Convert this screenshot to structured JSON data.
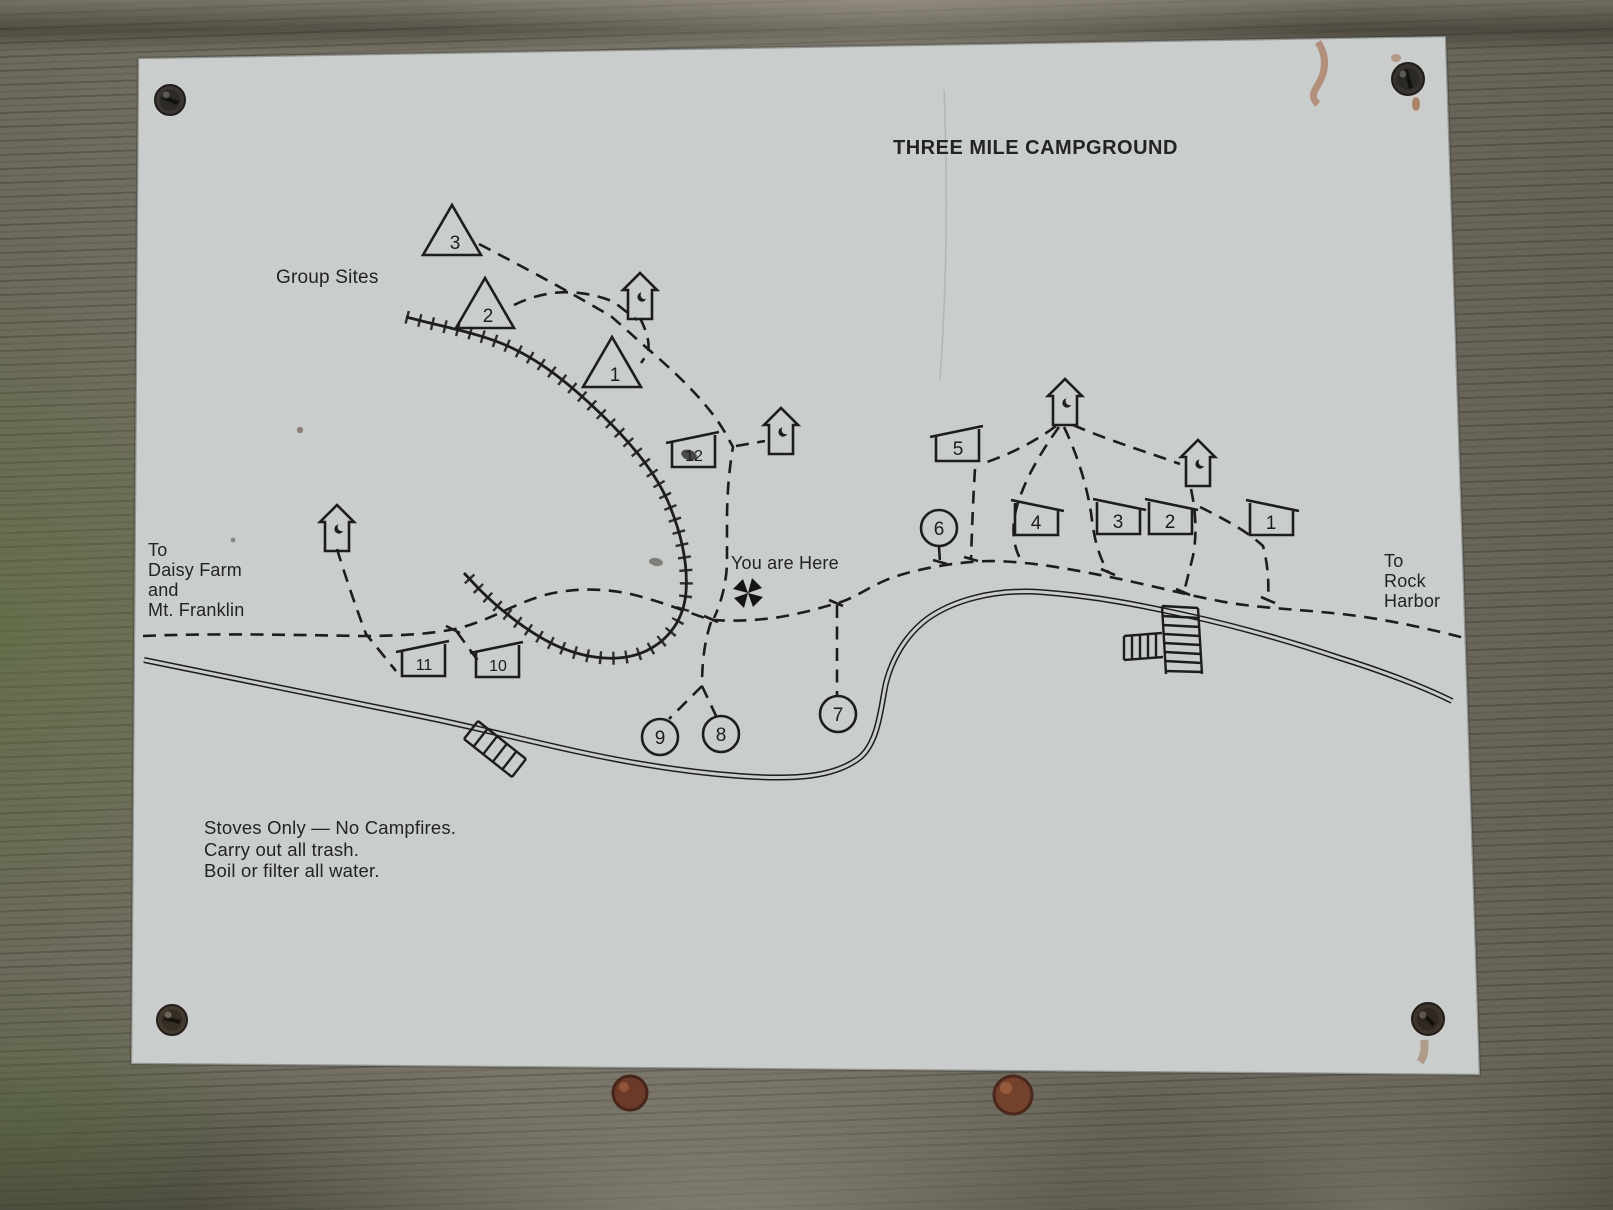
{
  "photo": {
    "sign_title": "THREE MILE CAMPGROUND",
    "labels": {
      "group_sites": "Group Sites",
      "you_are_here": "You are Here",
      "dest_left_lines": [
        "To",
        "Daisy Farm",
        "and",
        "Mt. Franklin"
      ],
      "dest_right_lines": [
        "To",
        "Rock",
        "Harbor"
      ],
      "rules_lines": [
        "Stoves Only — No Campfires.",
        "Carry out all trash.",
        "Boil or filter all water."
      ]
    },
    "colors": {
      "plate": "#c9cdcb",
      "ink": "#1d1d1b",
      "wood": "#716c60",
      "rust": "#7c4630"
    },
    "sites": {
      "group_triangles": [
        {
          "num": "3",
          "x": 452,
          "y": 232
        },
        {
          "num": "2",
          "x": 485,
          "y": 305
        },
        {
          "num": "1",
          "x": 612,
          "y": 364
        }
      ],
      "shelters": [
        {
          "num": "12",
          "x": 694,
          "y": 449,
          "slope": "up"
        },
        {
          "num": "11",
          "x": 424,
          "y": 658,
          "slope": "up"
        },
        {
          "num": "10",
          "x": 498,
          "y": 659,
          "slope": "up"
        },
        {
          "num": "5",
          "x": 958,
          "y": 443,
          "slope": "up"
        },
        {
          "num": "4",
          "x": 1036,
          "y": 517,
          "slope": "down"
        },
        {
          "num": "3",
          "x": 1118,
          "y": 516,
          "slope": "down"
        },
        {
          "num": "2",
          "x": 1170,
          "y": 516,
          "slope": "down"
        },
        {
          "num": "1",
          "x": 1271,
          "y": 517,
          "slope": "down"
        }
      ],
      "circles": [
        {
          "num": "6",
          "x": 939,
          "y": 528
        },
        {
          "num": "9",
          "x": 660,
          "y": 737
        },
        {
          "num": "8",
          "x": 721,
          "y": 734
        },
        {
          "num": "7",
          "x": 838,
          "y": 714
        }
      ],
      "outhouses": [
        {
          "x": 640,
          "y": 296
        },
        {
          "x": 781,
          "y": 431
        },
        {
          "x": 337,
          "y": 528
        },
        {
          "x": 1065,
          "y": 402
        },
        {
          "x": 1198,
          "y": 463
        }
      ]
    }
  }
}
